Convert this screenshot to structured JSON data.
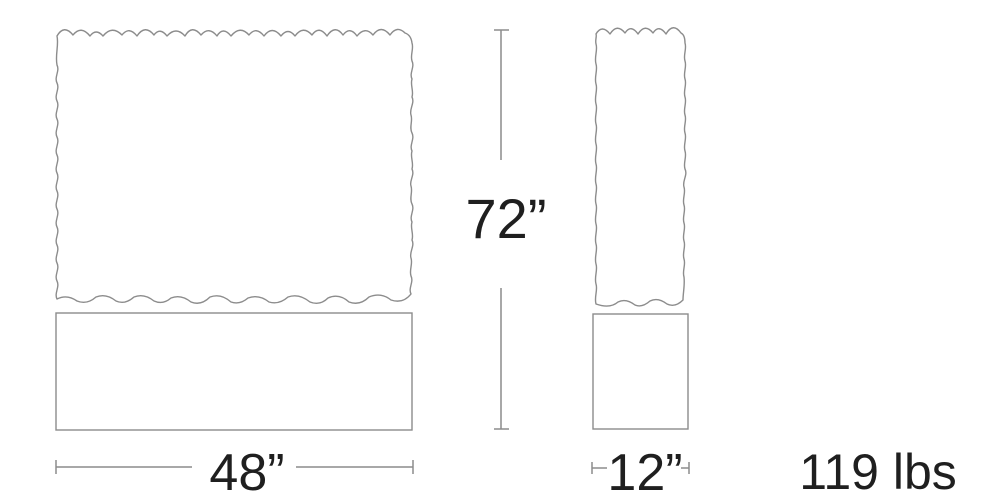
{
  "colors": {
    "outline": "#8c8c8c",
    "ink": "#1f1f1f"
  },
  "dimensions": {
    "height_label": "72”",
    "width_label": "48”",
    "depth_label": "12”",
    "weight_label": "119 lbs"
  }
}
